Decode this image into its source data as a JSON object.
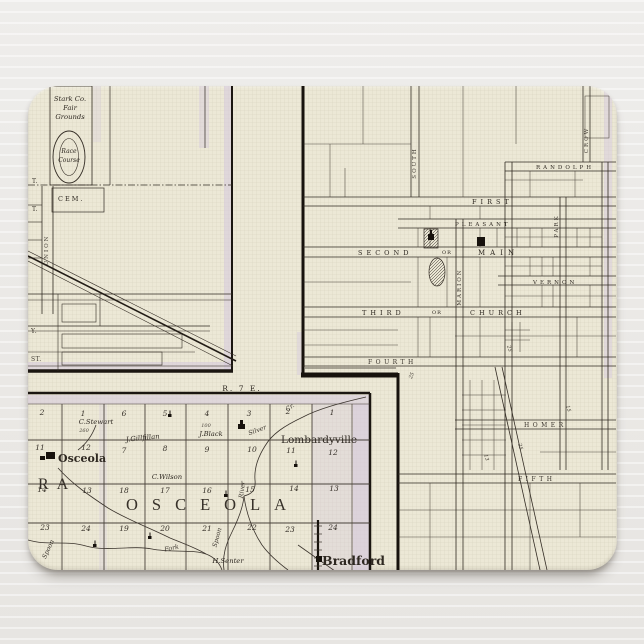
{
  "scene": {
    "bg_color": "#eae8e5",
    "pad_color": "#ece8d6",
    "ink_color": "#2e2821",
    "purple_accent": "#d5c9de"
  },
  "range_label": "R. 7 E.",
  "left_city": {
    "fairgrounds_line1": "Stark Co.",
    "fairgrounds_line2": "Fair",
    "fairgrounds_line3": "Grounds",
    "race_line1": "Race",
    "race_line2": "Course",
    "cemetery": "CEM.",
    "union_street": "UNION",
    "edge_labels": [
      "T.",
      "T.",
      "Y.",
      "ST."
    ]
  },
  "right_city": {
    "streets": {
      "randolph": "RANDOLPH",
      "first": "FIRST",
      "pleasant": "PLEASANT",
      "second": "SECOND",
      "or_main": "OR",
      "main": "MAIN",
      "vernon": "VERNON",
      "third": "THIRD",
      "or_church": "OR",
      "church": "CHURCH",
      "fourth": "FOURTH",
      "homer": "HOMER",
      "fifth": "FIFTH",
      "south": "SOUTH",
      "marion": "MARION",
      "crow": "CROW",
      "park": "PARK"
    },
    "lot_numbers": [
      "25",
      "25",
      "13",
      "15",
      "25"
    ]
  },
  "township": {
    "rows": [
      [
        "2",
        "1",
        "6",
        "5",
        "4",
        "3",
        "2",
        "1"
      ],
      [
        "11",
        "12",
        "7",
        "8",
        "9",
        "10",
        "11",
        "12"
      ],
      [
        "14",
        "13",
        "18",
        "17",
        "16",
        "15",
        "14",
        "13"
      ],
      [
        "23",
        "24",
        "19",
        "20",
        "21",
        "22",
        "23",
        "24"
      ]
    ],
    "big_west": "RA",
    "big_name": "OSCEOLA",
    "towns": {
      "osceola": "Osceola",
      "lombardyville": "Lombardyville",
      "bradford": "Bradford"
    },
    "owners": {
      "stewart": "C.Stewart",
      "stewart_acres": "260",
      "gillfillan": "J.Gillfillan",
      "black": "J.Black",
      "black_acres": "100",
      "wilson": "C.Wilson",
      "senter": "H.Senter"
    },
    "water": {
      "silver": "Silver",
      "cr": "Cr.",
      "river": "River",
      "spoon_a": "Spoon",
      "spoon_b": "Spoon",
      "fork": "Fork"
    }
  }
}
